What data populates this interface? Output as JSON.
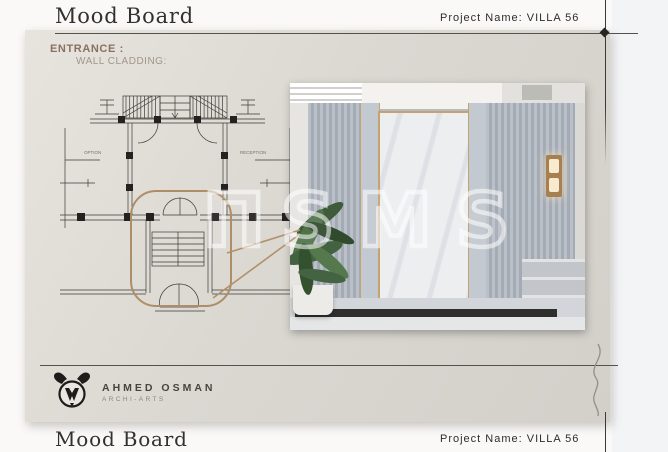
{
  "header": {
    "title": "Mood Board",
    "project_name": "Project Name: VILLA 56"
  },
  "section": {
    "title": "ENTRANCE :",
    "subtitle": "WALL CLADDING:"
  },
  "plan": {
    "label_left": "OPTION",
    "label_right": "RECEPTION"
  },
  "watermark": {
    "partial_glyph": "Π",
    "text": "SMS"
  },
  "logo": {
    "name": "AHMED OSMAN",
    "tagline": "ARCHI-ARTS"
  },
  "footer": {
    "title": "Mood Board",
    "project_name": "Project Name: VILLA 56"
  },
  "colors": {
    "accent_tan": "#ae8e66",
    "brass_trim": "#c5a36f",
    "card_bg": "#dbd8d2",
    "heading_brown": "#8a7060",
    "subheading_taupe": "#a2958a",
    "text_dark": "#2f2d2a"
  }
}
